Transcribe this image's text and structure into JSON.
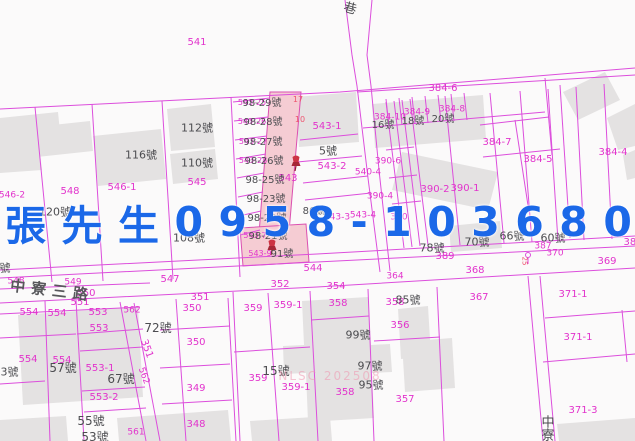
{
  "overlay": {
    "contact_text": "張先生0958-103680"
  },
  "watermark_text": "NLSC 202508",
  "colors": {
    "parcel_line": "#dc4edc",
    "parcel_text": "#e233cc",
    "house_text": "#4c4c50",
    "highlight_fill": "#f5ccd3",
    "building_fill": "#e4e2e2",
    "contact_blue": "#1b68e8",
    "red_label": "#ef5570",
    "pin_red": "#cc3344"
  },
  "map": {
    "labels": [
      {
        "t": "541",
        "x": 197,
        "y": 43,
        "c": "parcel"
      },
      {
        "t": "384-6",
        "x": 443,
        "y": 89,
        "c": "parcel"
      },
      {
        "t": "384-10",
        "x": 390,
        "y": 118,
        "c": "parcel",
        "s": 9
      },
      {
        "t": "384-9",
        "x": 417,
        "y": 113,
        "c": "parcel",
        "s": 9
      },
      {
        "t": "384-8",
        "x": 452,
        "y": 110,
        "c": "parcel",
        "s": 9
      },
      {
        "t": "384-7",
        "x": 497,
        "y": 143,
        "c": "parcel"
      },
      {
        "t": "384-5",
        "x": 538,
        "y": 160,
        "c": "parcel"
      },
      {
        "t": "384-4",
        "x": 613,
        "y": 153,
        "c": "parcel"
      },
      {
        "t": "543-1",
        "x": 327,
        "y": 127,
        "c": "parcel"
      },
      {
        "t": "543-2",
        "x": 332,
        "y": 167,
        "c": "parcel"
      },
      {
        "t": "543",
        "x": 288,
        "y": 179,
        "c": "parcel"
      },
      {
        "t": "390-6",
        "x": 388,
        "y": 162,
        "c": "parcel",
        "s": 9
      },
      {
        "t": "540-4",
        "x": 368,
        "y": 173,
        "c": "parcel",
        "s": 9
      },
      {
        "t": "390-4",
        "x": 380,
        "y": 197,
        "c": "parcel",
        "s": 9
      },
      {
        "t": "390-2",
        "x": 435,
        "y": 190,
        "c": "parcel"
      },
      {
        "t": "390-1",
        "x": 465,
        "y": 189,
        "c": "parcel"
      },
      {
        "t": "543-4",
        "x": 363,
        "y": 216,
        "c": "parcel",
        "s": 9
      },
      {
        "t": "543-3",
        "x": 337,
        "y": 218,
        "c": "parcel",
        "s": 9
      },
      {
        "t": "390",
        "x": 399,
        "y": 218,
        "c": "parcel",
        "s": 9
      },
      {
        "t": "546-2",
        "x": 12,
        "y": 196,
        "c": "parcel",
        "s": 9
      },
      {
        "t": "548",
        "x": 70,
        "y": 192,
        "c": "parcel"
      },
      {
        "t": "546-1",
        "x": 122,
        "y": 188,
        "c": "parcel"
      },
      {
        "t": "545",
        "x": 197,
        "y": 183,
        "c": "parcel"
      },
      {
        "t": "547",
        "x": 170,
        "y": 280,
        "c": "parcel"
      },
      {
        "t": "544",
        "x": 313,
        "y": 269,
        "c": "parcel"
      },
      {
        "t": "548",
        "x": 16,
        "y": 282,
        "c": "parcel",
        "s": 9
      },
      {
        "t": "549",
        "x": 73,
        "y": 283,
        "c": "parcel",
        "s": 9
      },
      {
        "t": "550",
        "x": 86,
        "y": 294,
        "c": "parcel"
      },
      {
        "t": "551",
        "x": 80,
        "y": 303,
        "c": "parcel"
      },
      {
        "t": "352",
        "x": 280,
        "y": 285,
        "c": "parcel"
      },
      {
        "t": "354",
        "x": 336,
        "y": 287,
        "c": "parcel"
      },
      {
        "t": "364",
        "x": 395,
        "y": 277,
        "c": "parcel",
        "s": 9
      },
      {
        "t": "351",
        "x": 200,
        "y": 298,
        "c": "parcel"
      },
      {
        "t": "389",
        "x": 445,
        "y": 257,
        "c": "parcel"
      },
      {
        "t": "387",
        "x": 543,
        "y": 247,
        "c": "parcel",
        "s": 9
      },
      {
        "t": "370",
        "x": 555,
        "y": 254,
        "c": "parcel",
        "s": 9
      },
      {
        "t": "369",
        "x": 607,
        "y": 262,
        "c": "parcel"
      },
      {
        "t": "368",
        "x": 475,
        "y": 271,
        "c": "parcel"
      },
      {
        "t": "385",
        "x": 633,
        "y": 243,
        "c": "parcel"
      },
      {
        "t": "367",
        "x": 479,
        "y": 298,
        "c": "parcel"
      },
      {
        "t": "371-1",
        "x": 573,
        "y": 295,
        "c": "parcel"
      },
      {
        "t": "371-1",
        "x": 578,
        "y": 338,
        "c": "parcel"
      },
      {
        "t": "371-3",
        "x": 583,
        "y": 411,
        "c": "parcel"
      },
      {
        "t": "350",
        "x": 192,
        "y": 309,
        "c": "parcel"
      },
      {
        "t": "350",
        "x": 196,
        "y": 343,
        "c": "parcel"
      },
      {
        "t": "349",
        "x": 196,
        "y": 389,
        "c": "parcel"
      },
      {
        "t": "348",
        "x": 196,
        "y": 425,
        "c": "parcel"
      },
      {
        "t": "351",
        "x": 146,
        "y": 349,
        "c": "parcel",
        "rot": 70
      },
      {
        "t": "562",
        "x": 132,
        "y": 311,
        "c": "parcel",
        "s": 9
      },
      {
        "t": "562",
        "x": 143,
        "y": 376,
        "c": "parcel",
        "s": 9,
        "rot": 70
      },
      {
        "t": "561",
        "x": 136,
        "y": 433,
        "c": "parcel",
        "s": 9
      },
      {
        "t": "554",
        "x": 29,
        "y": 313,
        "c": "parcel"
      },
      {
        "t": "554",
        "x": 57,
        "y": 314,
        "c": "parcel"
      },
      {
        "t": "553",
        "x": 98,
        "y": 313,
        "c": "parcel"
      },
      {
        "t": "553",
        "x": 99,
        "y": 329,
        "c": "parcel"
      },
      {
        "t": "554",
        "x": 28,
        "y": 360,
        "c": "parcel"
      },
      {
        "t": "554",
        "x": 62,
        "y": 361,
        "c": "parcel"
      },
      {
        "t": "553-1",
        "x": 100,
        "y": 369,
        "c": "parcel"
      },
      {
        "t": "553-2",
        "x": 104,
        "y": 398,
        "c": "parcel"
      },
      {
        "t": "359",
        "x": 253,
        "y": 309,
        "c": "parcel"
      },
      {
        "t": "359-1",
        "x": 288,
        "y": 306,
        "c": "parcel"
      },
      {
        "t": "358",
        "x": 338,
        "y": 304,
        "c": "parcel"
      },
      {
        "t": "358",
        "x": 395,
        "y": 303,
        "c": "parcel"
      },
      {
        "t": "356",
        "x": 400,
        "y": 326,
        "c": "parcel"
      },
      {
        "t": "359",
        "x": 258,
        "y": 379,
        "c": "parcel"
      },
      {
        "t": "359-1",
        "x": 296,
        "y": 388,
        "c": "parcel"
      },
      {
        "t": "358",
        "x": 345,
        "y": 393,
        "c": "parcel"
      },
      {
        "t": "357",
        "x": 405,
        "y": 400,
        "c": "parcel"
      },
      {
        "t": "543-25",
        "x": 252,
        "y": 103,
        "c": "parcel",
        "s": 8
      },
      {
        "t": "543-26",
        "x": 252,
        "y": 122,
        "c": "parcel",
        "s": 8
      },
      {
        "t": "543-27",
        "x": 253,
        "y": 142,
        "c": "parcel",
        "s": 8
      },
      {
        "t": "543-28",
        "x": 253,
        "y": 161,
        "c": "parcel",
        "s": 8
      },
      {
        "t": "543-7",
        "x": 255,
        "y": 236,
        "c": "parcel",
        "s": 8
      },
      {
        "t": "543-9",
        "x": 260,
        "y": 254,
        "c": "parcel",
        "s": 8
      },
      {
        "t": "17",
        "x": 298,
        "y": 100,
        "c": "red"
      },
      {
        "t": "10",
        "x": 300,
        "y": 120,
        "c": "red"
      },
      {
        "t": "25",
        "x": 524,
        "y": 261,
        "c": "red",
        "s": 7,
        "rot": 90
      },
      {
        "t": "巷",
        "x": 350,
        "y": 9,
        "c": "house",
        "s": 13,
        "rot": 15
      },
      {
        "t": "112號",
        "x": 197,
        "y": 128,
        "c": "house"
      },
      {
        "t": "116號",
        "x": 141,
        "y": 155,
        "c": "house"
      },
      {
        "t": "110號",
        "x": 197,
        "y": 163,
        "c": "house"
      },
      {
        "t": "120號",
        "x": 55,
        "y": 212,
        "c": "house"
      },
      {
        "t": "108號",
        "x": 189,
        "y": 238,
        "c": "house"
      },
      {
        "t": "98-29號",
        "x": 262,
        "y": 104,
        "c": "house",
        "s": 10
      },
      {
        "t": "98-28號",
        "x": 263,
        "y": 123,
        "c": "house",
        "s": 10
      },
      {
        "t": "98-27號",
        "x": 263,
        "y": 143,
        "c": "house",
        "s": 10
      },
      {
        "t": "98-26號",
        "x": 264,
        "y": 162,
        "c": "house",
        "s": 10
      },
      {
        "t": "98-25號",
        "x": 265,
        "y": 181,
        "c": "house",
        "s": 10
      },
      {
        "t": "98-23號",
        "x": 266,
        "y": 200,
        "c": "house",
        "s": 10
      },
      {
        "t": "98-22號",
        "x": 267,
        "y": 219,
        "c": "house",
        "s": 10
      },
      {
        "t": "98-21號",
        "x": 268,
        "y": 237,
        "c": "house",
        "s": 10
      },
      {
        "t": "91號",
        "x": 282,
        "y": 255,
        "c": "house",
        "s": 10
      },
      {
        "t": "5號",
        "x": 328,
        "y": 151,
        "c": "house"
      },
      {
        "t": "16號",
        "x": 383,
        "y": 126,
        "c": "house",
        "s": 10
      },
      {
        "t": "18號",
        "x": 413,
        "y": 122,
        "c": "house",
        "s": 10
      },
      {
        "t": "20號",
        "x": 443,
        "y": 120,
        "c": "house",
        "s": 10
      },
      {
        "t": "86號",
        "x": 314,
        "y": 212,
        "c": "house",
        "s": 10
      },
      {
        "t": "78號",
        "x": 432,
        "y": 248,
        "c": "house"
      },
      {
        "t": "70號",
        "x": 477,
        "y": 242,
        "c": "house"
      },
      {
        "t": "66號",
        "x": 512,
        "y": 236,
        "c": "house"
      },
      {
        "t": "60號",
        "x": 553,
        "y": 238,
        "c": "house"
      },
      {
        "t": "72號",
        "x": 158,
        "y": 328,
        "c": "house",
        "s": 12
      },
      {
        "t": "57號",
        "x": 63,
        "y": 368,
        "c": "house",
        "s": 12
      },
      {
        "t": "63號",
        "x": 6,
        "y": 372,
        "c": "house"
      },
      {
        "t": "67號",
        "x": 121,
        "y": 379,
        "c": "house",
        "s": 12
      },
      {
        "t": "55號",
        "x": 91,
        "y": 421,
        "c": "house",
        "s": 12
      },
      {
        "t": "53號",
        "x": 95,
        "y": 437,
        "c": "house",
        "s": 12
      },
      {
        "t": "85號",
        "x": 408,
        "y": 300,
        "c": "house"
      },
      {
        "t": "99號",
        "x": 358,
        "y": 335,
        "c": "house"
      },
      {
        "t": "15號",
        "x": 276,
        "y": 371,
        "c": "house",
        "s": 12
      },
      {
        "t": "97號",
        "x": 370,
        "y": 366,
        "c": "house"
      },
      {
        "t": "95號",
        "x": 371,
        "y": 385,
        "c": "house"
      },
      {
        "t": "62號",
        "x": -2,
        "y": 268,
        "c": "house"
      },
      {
        "t": "中寮",
        "x": 546,
        "y": 428,
        "c": "house",
        "s": 13,
        "v": 1
      },
      {
        "t": "中寮三路",
        "x": 52,
        "y": 291,
        "c": "street",
        "rot": 7
      },
      {
        "t": "NLSC 202508",
        "x": 330,
        "y": 376,
        "c": "watermark"
      }
    ]
  }
}
